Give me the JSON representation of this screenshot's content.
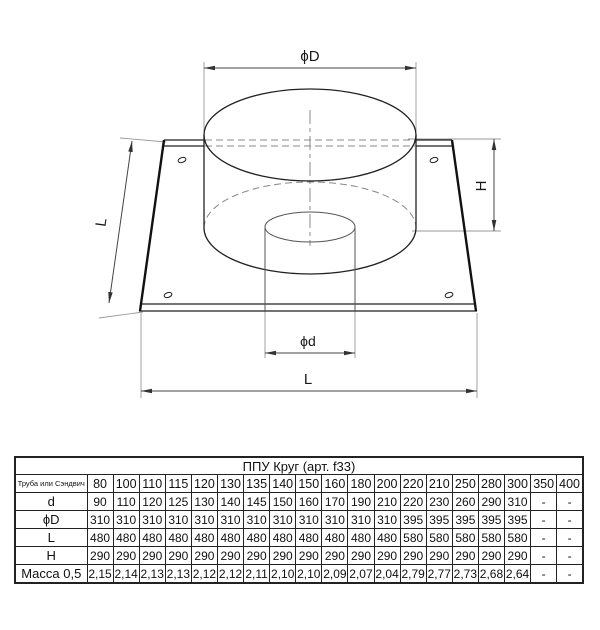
{
  "drawing": {
    "labels": {
      "dia_D": "ϕD",
      "dia_d": "ϕd",
      "height": "H",
      "length_side": "L",
      "length_bottom": "L"
    }
  },
  "table": {
    "title": "ППУ Круг (арт. f33)",
    "corner_header": "Труба или Сэндвич",
    "size_columns": [
      "80",
      "100",
      "110",
      "115",
      "120",
      "130",
      "135",
      "140",
      "150",
      "160",
      "180",
      "200",
      "220",
      "210",
      "250",
      "280",
      "300",
      "350",
      "400"
    ],
    "rows": [
      {
        "label": "d",
        "values": [
          "90",
          "110",
          "120",
          "125",
          "130",
          "140",
          "145",
          "150",
          "160",
          "170",
          "190",
          "210",
          "220",
          "230",
          "260",
          "290",
          "310",
          "-",
          "-"
        ]
      },
      {
        "label": "ϕD",
        "values": [
          "310",
          "310",
          "310",
          "310",
          "310",
          "310",
          "310",
          "310",
          "310",
          "310",
          "310",
          "310",
          "395",
          "395",
          "395",
          "395",
          "395",
          "-",
          "-"
        ]
      },
      {
        "label": "L",
        "values": [
          "480",
          "480",
          "480",
          "480",
          "480",
          "480",
          "480",
          "480",
          "480",
          "480",
          "480",
          "480",
          "580",
          "580",
          "580",
          "580",
          "580",
          "-",
          "-"
        ]
      },
      {
        "label": "H",
        "values": [
          "290",
          "290",
          "290",
          "290",
          "290",
          "290",
          "290",
          "290",
          "290",
          "290",
          "290",
          "290",
          "290",
          "290",
          "290",
          "290",
          "290",
          "-",
          "-"
        ]
      },
      {
        "label": "Масса 0,5",
        "values": [
          "2,15",
          "2,14",
          "2,13",
          "2,13",
          "2,12",
          "2,12",
          "2,11",
          "2,10",
          "2,10",
          "2,09",
          "2,07",
          "2,04",
          "2,79",
          "2,77",
          "2,73",
          "2,68",
          "2,64",
          "-",
          "-"
        ]
      }
    ]
  }
}
